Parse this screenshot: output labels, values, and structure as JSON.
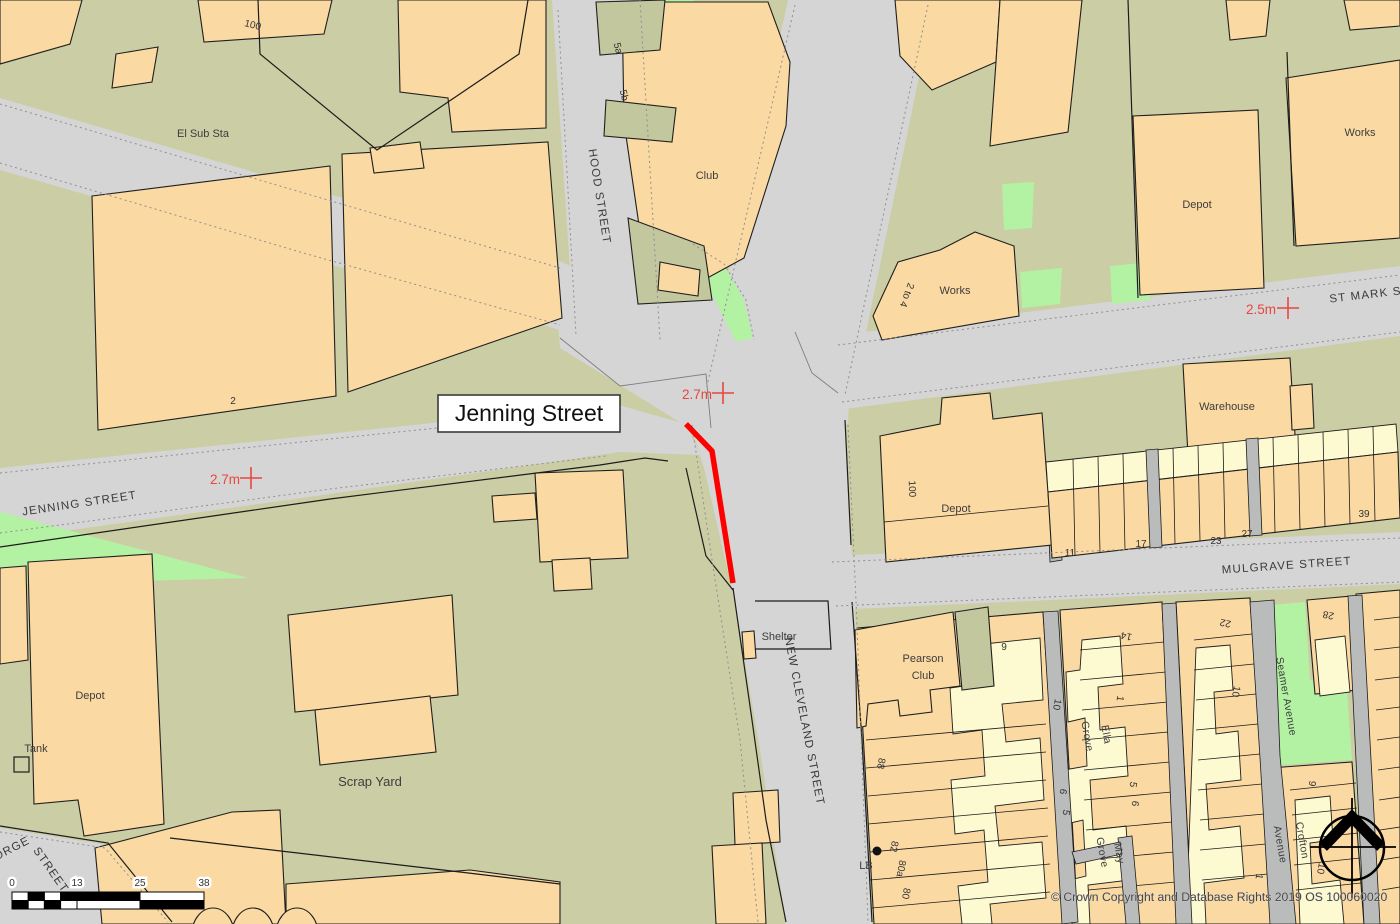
{
  "map": {
    "title": "Jenning Street",
    "copyright": "© Crown Copyright and Database Rights 2019 OS 100060020",
    "colors": {
      "road": "#d5d5d5",
      "land": "#cbcda5",
      "building": "#fbd9a2",
      "building_pale": "#fdf9d0",
      "open_green": "#b3f2a2",
      "route_highlight": "#ff0000",
      "benchmark": "#e8473f"
    },
    "scale_ticks": [
      "0",
      "13",
      "25",
      "38"
    ],
    "benchmarks": [
      {
        "value": "2.7m"
      },
      {
        "value": "2.7m"
      },
      {
        "value": "2.5m"
      }
    ],
    "streets": [
      {
        "name": "HOOD STREET"
      },
      {
        "name": "JENNING STREET"
      },
      {
        "name": "ST MARK ST"
      },
      {
        "name": "MULGRAVE STREET"
      },
      {
        "name": "NEW CLEVELAND STREET"
      },
      {
        "name": "GEORGE"
      },
      {
        "name": "STREET"
      },
      {
        "name": "Seamer Avenue"
      },
      {
        "name": "Grove"
      },
      {
        "name": "Ella"
      },
      {
        "name": "Grove"
      },
      {
        "name": "May"
      },
      {
        "name": "Avenue"
      },
      {
        "name": "Crofton"
      }
    ],
    "places": [
      {
        "name": "El Sub Sta"
      },
      {
        "name": "Club"
      },
      {
        "name": "Works"
      },
      {
        "name": "Depot"
      },
      {
        "name": "Works"
      },
      {
        "name": "Warehouse"
      },
      {
        "name": "Depot"
      },
      {
        "name": "Shelter"
      },
      {
        "name": "Pearson"
      },
      {
        "name": "Club"
      },
      {
        "name": "Depot"
      },
      {
        "name": "Tank"
      },
      {
        "name": "Scrap Yard"
      },
      {
        "name": "LB"
      }
    ],
    "numbers": [
      "100",
      "2",
      "5a",
      "5b",
      "2 to 4",
      "100",
      "11",
      "17",
      "23",
      "27",
      "39",
      "9",
      "14",
      "22",
      "28",
      "10",
      "1",
      "10",
      "6",
      "5",
      "5",
      "6",
      "88",
      "82",
      "80a",
      "80",
      "1",
      "10",
      "9"
    ]
  }
}
